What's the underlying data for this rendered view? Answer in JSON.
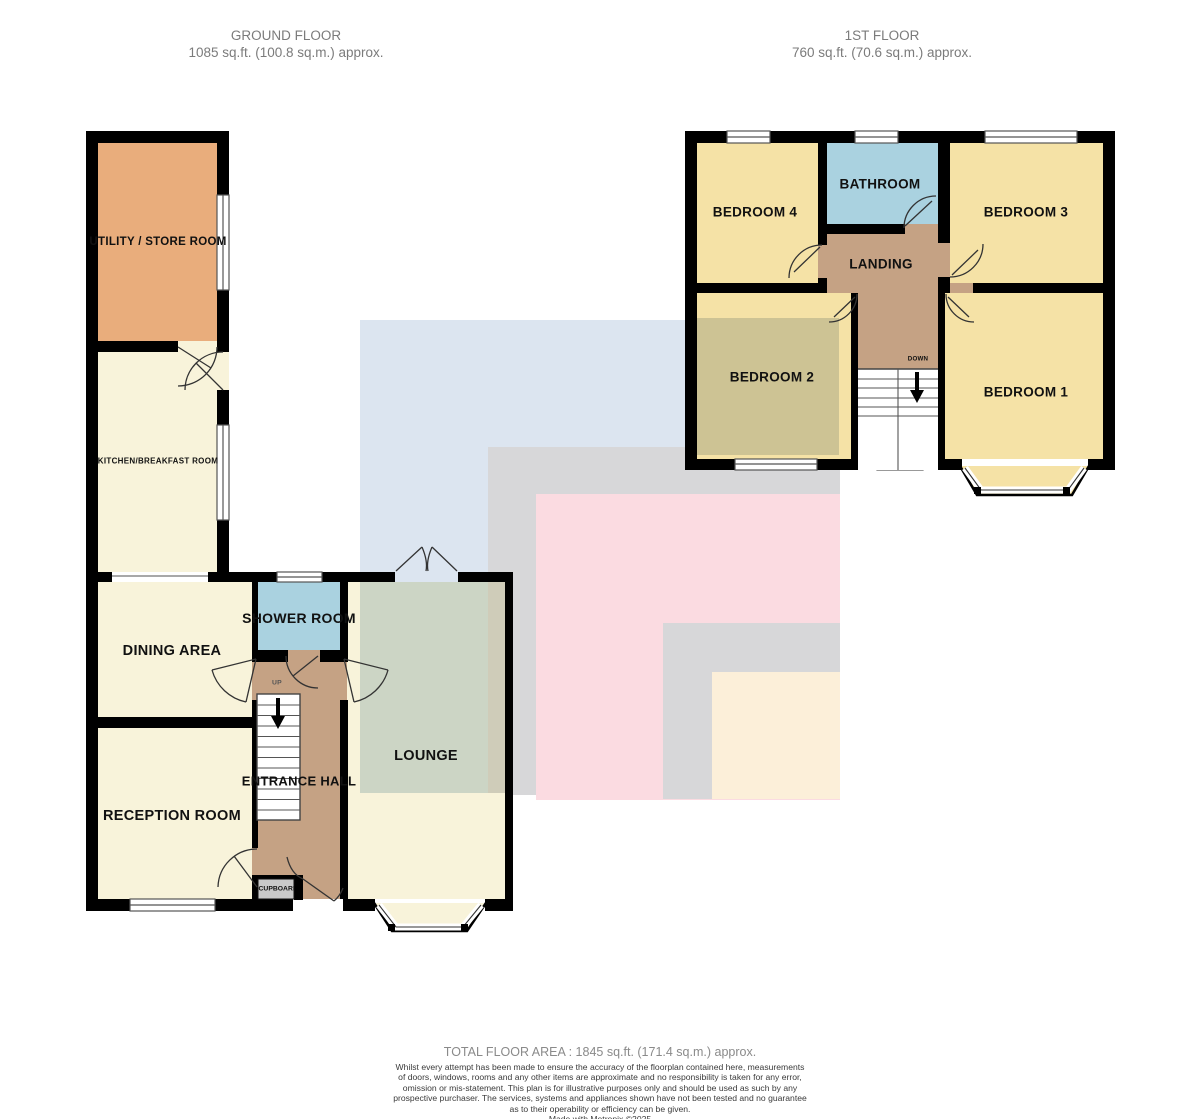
{
  "header": {
    "ground": {
      "title": "GROUND FLOOR",
      "area": "1085 sq.ft. (100.8 sq.m.) approx."
    },
    "first": {
      "title": "1ST FLOOR",
      "area": "760 sq.ft. (70.6 sq.m.) approx."
    }
  },
  "rooms": {
    "utility": "UTILITY / STORE ROOM",
    "kitchen": "KITCHEN/BREAKFAST ROOM",
    "dining": "DINING AREA",
    "shower": "SHOWER ROOM",
    "entrance": "ENTRANCE HALL",
    "reception": "RECEPTION ROOM",
    "lounge": "LOUNGE",
    "cupboard": "CUPBOARD",
    "up": "UP",
    "bedroom4": "BEDROOM 4",
    "bathroom": "BATHROOM",
    "bedroom3": "BEDROOM 3",
    "landing": "LANDING",
    "bedroom2": "BEDROOM 2",
    "bedroom1": "BEDROOM 1",
    "down": "DOWN"
  },
  "footer": {
    "total": "TOTAL FLOOR AREA : 1845 sq.ft. (171.4 sq.m.) approx.",
    "disclaimer_lines": [
      "Whilst every attempt has been made to ensure the accuracy of the floorplan contained here, measurements",
      "of doors, windows, rooms and any other items are approximate and no responsibility is taken for any error,",
      "omission or mis-statement. This plan is for illustrative purposes only and should be used as such by any",
      "prospective purchaser. The services, systems and appliances shown have not been tested and no guarantee",
      "as to their operability or efficiency can be given."
    ],
    "credit": "Made with Metropix ©2025"
  },
  "colors": {
    "wall": "#000000",
    "room_cream": "#f8f3da",
    "room_yellow": "#f5e2a6",
    "room_orange": "#e9ad7c",
    "room_blue": "#aad2e0",
    "hall_tan": "#c5a284",
    "bedroom2_tint": "#cdc394",
    "lounge_tint_green": "#ccd5c5",
    "lounge_tint_gray": "#cfccb9",
    "wm_blue": "#dce5f0",
    "wm_gray": "#d7d7d9",
    "wm_pink": "#fbdbe1",
    "wm_cream": "#fcefd9",
    "cupboard_gray": "#c9c9c9"
  }
}
